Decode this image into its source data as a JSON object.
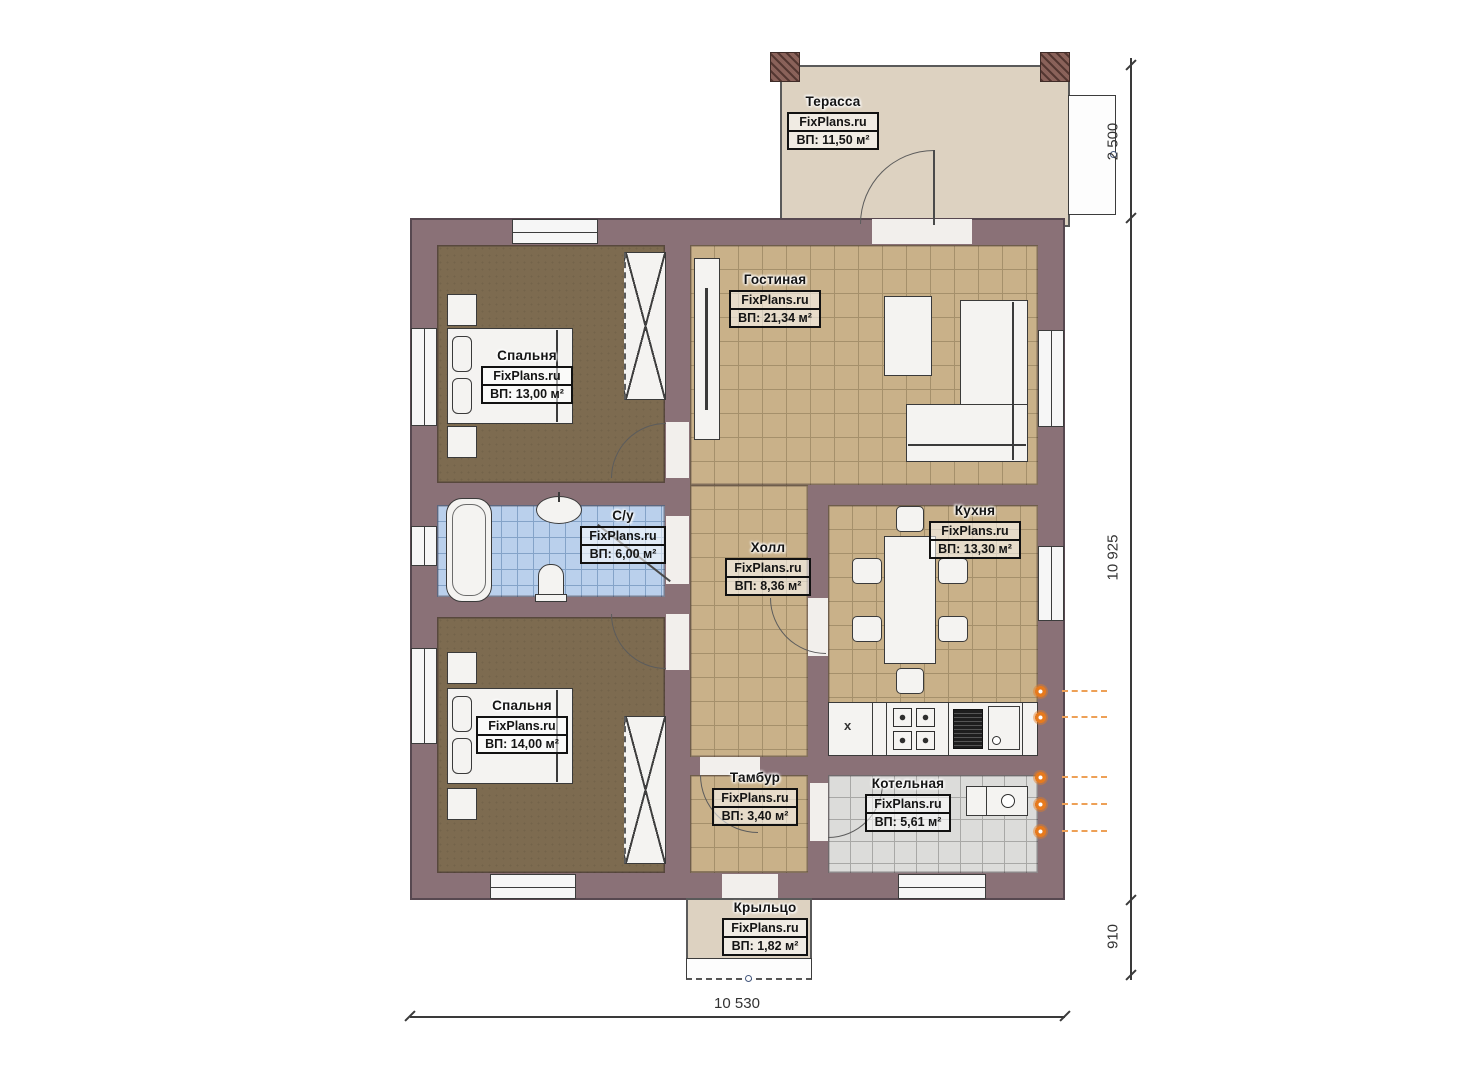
{
  "rooms": [
    {
      "name": "Терасса",
      "brand": "FixPlans.ru",
      "area": "ВП: 11,50 м²"
    },
    {
      "name": "Гостиная",
      "brand": "FixPlans.ru",
      "area": "ВП: 21,34 м²"
    },
    {
      "name": "Спальня",
      "brand": "FixPlans.ru",
      "area": "ВП: 13,00 м²"
    },
    {
      "name": "С/у",
      "brand": "FixPlans.ru",
      "area": "ВП: 6,00 м²"
    },
    {
      "name": "Холл",
      "brand": "FixPlans.ru",
      "area": "ВП: 8,36 м²"
    },
    {
      "name": "Кухня",
      "brand": "FixPlans.ru",
      "area": "ВП: 13,30 м²"
    },
    {
      "name": "Спальня",
      "brand": "FixPlans.ru",
      "area": "ВП: 14,00 м²"
    },
    {
      "name": "Тамбур",
      "brand": "FixPlans.ru",
      "area": "ВП: 3,40 м²"
    },
    {
      "name": "Котельная",
      "brand": "FixPlans.ru",
      "area": "ВП: 5,61 м²"
    },
    {
      "name": "Крыльцо",
      "brand": "FixPlans.ru",
      "area": "ВП: 1,82 м²"
    }
  ],
  "dimensions": {
    "terrace_height": "2 500",
    "building_height": "10 925",
    "porch_height": "910",
    "building_width": "10 530"
  },
  "kitchen": {
    "cabinet_mark": "x"
  },
  "colors": {
    "wall": "#8a7177",
    "floor_tile": "#c9b189",
    "bedroom_floor": "#7d6b50",
    "bath_tile": "#bad0ec",
    "boiler_tile": "#dcdcda",
    "terrace_floor": "#ddd2c1",
    "radiator_accent": "#e67a1e"
  }
}
